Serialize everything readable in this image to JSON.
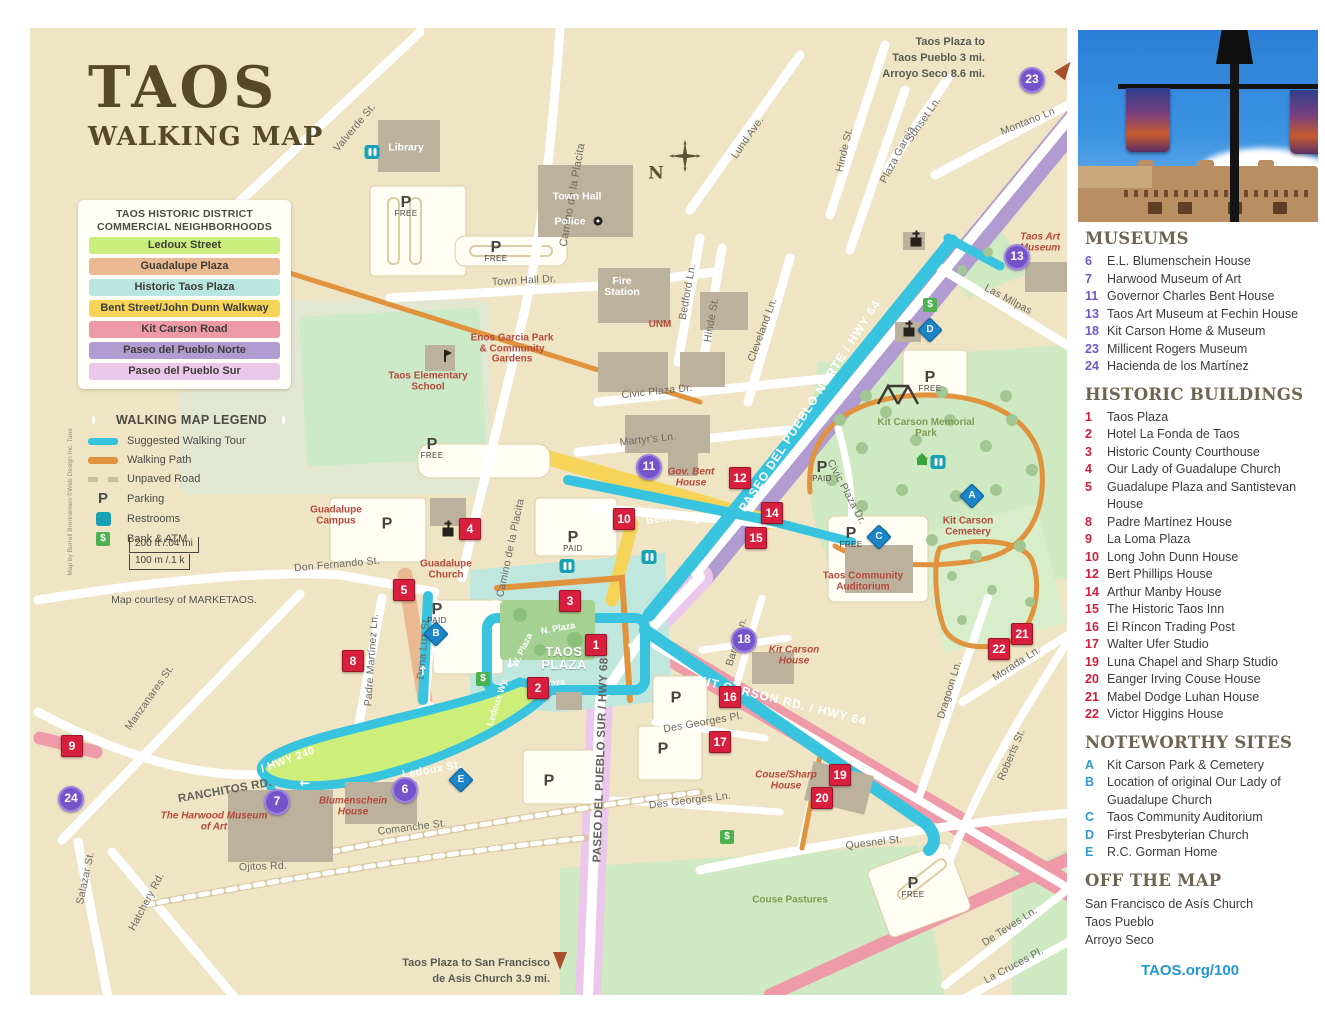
{
  "title": {
    "line1": "TAOS",
    "line2": "WALKING MAP"
  },
  "legend": {
    "header1": "TAOS HISTORIC DISTRICT",
    "header2": "COMMERCIAL NEIGHBORHOODS",
    "districts": [
      {
        "label": "Ledoux Street",
        "color": "#c9ee7d"
      },
      {
        "label": "Guadalupe Plaza",
        "color": "#eab992"
      },
      {
        "label": "Historic Taos Plaza",
        "color": "#b9e6de"
      },
      {
        "label": "Bent Street/John Dunn Walkway",
        "color": "#f6d457"
      },
      {
        "label": "Kit Carson Road",
        "color": "#ee9aa6"
      },
      {
        "label": "Paseo del Pueblo Norte",
        "color": "#b29bd0"
      },
      {
        "label": "Paseo del Pueblo Sur",
        "color": "#ecc7ec"
      }
    ],
    "walking_title": "WALKING MAP LEGEND",
    "walking": [
      {
        "label": "Suggested Walking Tour",
        "color": "#35c3dd"
      },
      {
        "label": "Walking Path",
        "color": "#e0923c"
      },
      {
        "label": "Unpaved Road",
        "color": "#cbbd96"
      },
      {
        "label": "Parking"
      },
      {
        "label": "Restrooms",
        "color": "#18a0b4"
      },
      {
        "label": "Bank & ATM",
        "color": "#4db24d"
      }
    ],
    "scale_top": "200 ft /.04 mi",
    "scale_bottom": "100 m /.1 k",
    "courtesy": "Map courtesy of MARKETAOS.",
    "attribution": "Map by Burrell Brennemen ©Web Design Inc. Taos"
  },
  "notes": {
    "tr1": "Taos Plaza to",
    "tr2": "Taos Pueblo 3 mi.",
    "tr3": "Arroyo Seco 8.6 mi.",
    "b1": "Taos Plaza to San Francisco",
    "b2": "de Asis Church 3.9 mi.",
    "compass": "N"
  },
  "glyphs": {
    "p": "P",
    "free": "FREE",
    "paid": "PAID",
    "dollar": "$",
    "left": "←",
    "right": "→",
    "up": "↑",
    "down": "↓",
    "both": "↔"
  },
  "streets": [
    "Valverde St.",
    "Camino de la Placita",
    "Lund Ave.",
    "Hinde St.",
    "Plaza Garcia",
    "Sunset Ln.",
    "Montano Ln",
    "Las Milpas",
    "Town Hall Dr.",
    "Bedford Ln.",
    "Hinde St.",
    "Cleveland Ln.",
    "Civic Plaza Dr.",
    "Martyr's Ln.",
    "Don Fernando St.",
    "Camino de la Placita",
    "Padre Martínez Ln.",
    "Dona Luz St.",
    "Manzanares St.",
    "Salazar St.",
    "Hatchery Rd.",
    "RANCHITOS RD.",
    "/ HWY 240",
    "Ledoux St.",
    "Comanche St.",
    "Ojitos Rd.",
    "PASEO DEL PUEBLO SUR / HWY 68",
    "Des Georges Pl.",
    "Des Georges Ln.",
    "KIT CARSON RD. / HWY 64",
    "PASEO DEL PUEBLO NORTE / HWY 64",
    "Quesnel St.",
    "Dragoon Ln.",
    "Morada Ln.",
    "Roberts St.",
    "De Teves Ln.",
    "La Cruces Pl.",
    "Barela Ln.",
    "Bent St.",
    "N. Plaza",
    "W. Plaza",
    "S. Plaza",
    "Civic Plaza Dr.",
    "Ledoux Wy."
  ],
  "places": {
    "library": "Library",
    "town_hall": "Town Hall",
    "police": "Police",
    "fire_station": "Fire Station",
    "unm": "UNM",
    "enos": "Enos Garcia Park & Community Gardens",
    "elementary": "Taos Elementary School",
    "guadalupe_campus": "Guadalupe Campus",
    "guadalupe_church": "Guadalupe Church",
    "gov_bent": "Gov. Bent House",
    "taos_art": "Taos Art Museum",
    "kc_park": "Kit Carson Memorial Park",
    "kc_cemetery": "Kit Carson Cemetery",
    "auditorium": "Taos Community Auditorium",
    "kc_house": "Kit Carson House",
    "harwood": "The Harwood Museum of Art",
    "blumenschein": "Blumenschein House",
    "couse": "Couse/Sharp House",
    "pastures": "Couse Pastures",
    "taos_plaza": "TAOS PLAZA"
  },
  "markers": {
    "red": [
      "1",
      "2",
      "3",
      "4",
      "5",
      "8",
      "9",
      "10",
      "12",
      "14",
      "15",
      "16",
      "17",
      "19",
      "20",
      "21",
      "22"
    ],
    "purple": [
      "6",
      "7",
      "11",
      "13",
      "18",
      "23",
      "24"
    ],
    "letters": [
      "A",
      "B",
      "C",
      "D",
      "E"
    ]
  },
  "sidebar": {
    "museums_title": "MUSEUMS",
    "museums": [
      {
        "n": "6",
        "name": "E.L. Blumenschein House"
      },
      {
        "n": "7",
        "name": "Harwood Museum of Art"
      },
      {
        "n": "11",
        "name": "Governor Charles Bent House"
      },
      {
        "n": "13",
        "name": "Taos Art Museum at Fechin House"
      },
      {
        "n": "18",
        "name": "Kit Carson Home & Museum"
      },
      {
        "n": "23",
        "name": "Millicent Rogers Museum"
      },
      {
        "n": "24",
        "name": "Hacienda de los Martínez"
      }
    ],
    "historic_title": "HISTORIC BUILDINGS",
    "historic": [
      {
        "n": "1",
        "name": "Taos Plaza"
      },
      {
        "n": "2",
        "name": "Hotel La Fonda de Taos"
      },
      {
        "n": "3",
        "name": "Historic County Courthouse"
      },
      {
        "n": "4",
        "name": "Our Lady of Guadalupe Church"
      },
      {
        "n": "5",
        "name": "Guadalupe Plaza and Santistevan House"
      },
      {
        "n": "8",
        "name": "Padre Martínez House"
      },
      {
        "n": "9",
        "name": "La Loma Plaza"
      },
      {
        "n": "10",
        "name": "Long John Dunn House"
      },
      {
        "n": "12",
        "name": "Bert Phillips House"
      },
      {
        "n": "14",
        "name": "Arthur Manby House"
      },
      {
        "n": "15",
        "name": "The Historic Taos Inn"
      },
      {
        "n": "16",
        "name": "El Ríncon Trading Post"
      },
      {
        "n": "17",
        "name": "Walter Ufer Studio"
      },
      {
        "n": "19",
        "name": "Luna Chapel and Sharp Studio"
      },
      {
        "n": "20",
        "name": "Eanger Irving Couse House"
      },
      {
        "n": "21",
        "name": "Mabel Dodge Luhan House"
      },
      {
        "n": "22",
        "name": "Victor Higgins House"
      }
    ],
    "noteworthy_title": "NOTEWORTHY SITES",
    "noteworthy": [
      {
        "n": "A",
        "name": "Kit Carson Park & Cemetery"
      },
      {
        "n": "B",
        "name": "Location of original Our Lady of Guadalupe Church"
      },
      {
        "n": "C",
        "name": "Taos Community Auditorium"
      },
      {
        "n": "D",
        "name": "First Presbyterian Church"
      },
      {
        "n": "E",
        "name": "R.C. Gorman Home"
      }
    ],
    "offmap_title": "OFF THE MAP",
    "offmap": [
      "San Francisco de Asís Church",
      "Taos Pueblo",
      "Arroyo Seco"
    ],
    "url": "TAOS.org/100"
  }
}
